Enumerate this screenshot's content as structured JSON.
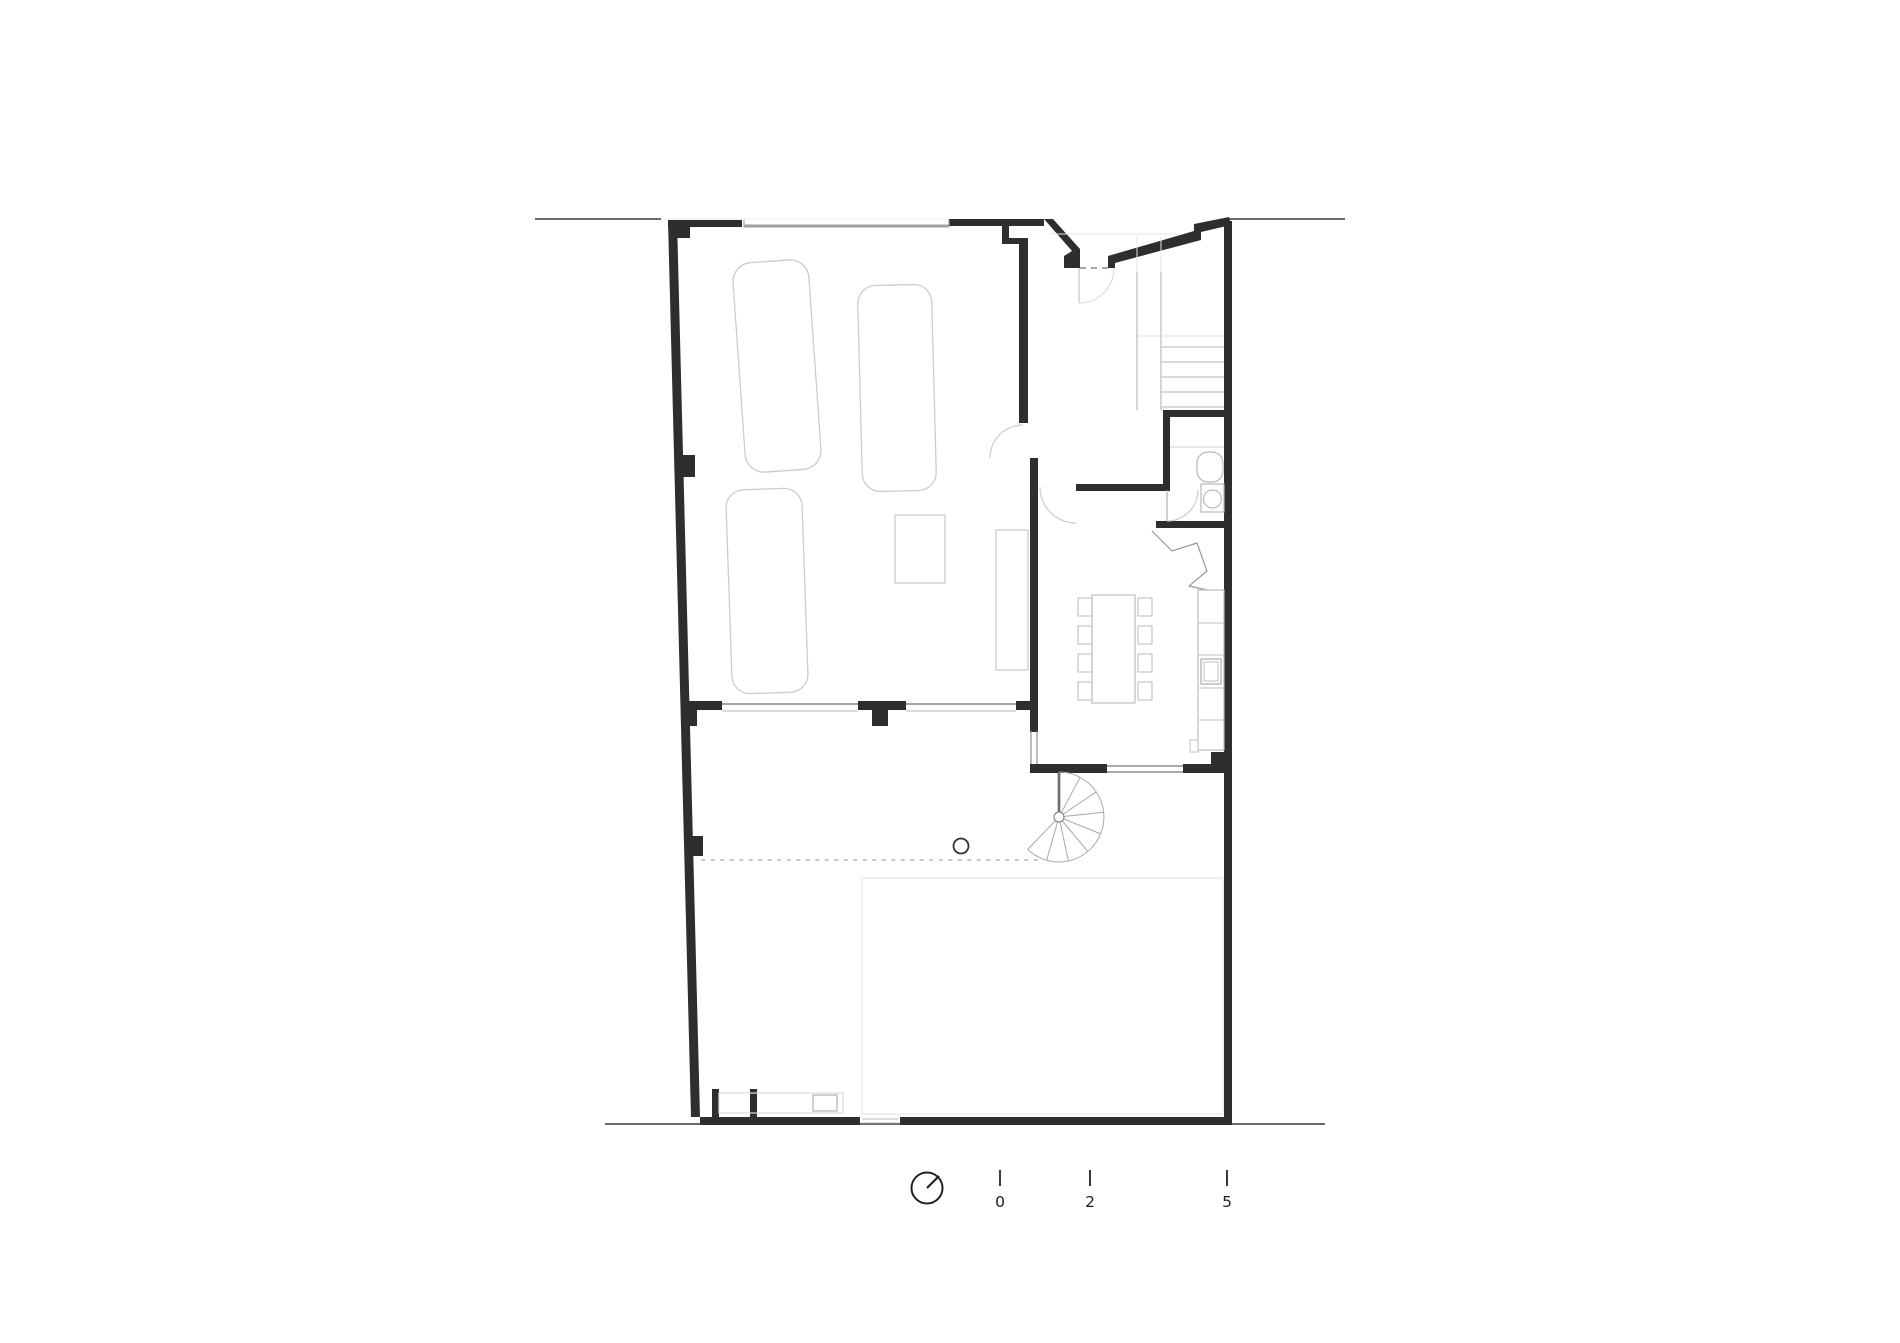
{
  "drawing": {
    "kind": "architectural ground floor plan",
    "colors": {
      "background": "#ffffff",
      "walls": "#2e2e2e",
      "site_lines": "#3a3a3a",
      "furniture_light": "#c9c9c9",
      "stair_gray": "#aaaaaa",
      "paving": "#e4e4e4",
      "garage_door": "#a0a0a0"
    },
    "symbols": [
      "car-outline",
      "car-outline",
      "car-outline",
      "straight-stair",
      "spiral-stair",
      "entry-door-arc",
      "interior-door-arc",
      "washbasin",
      "washing-machine",
      "dining-table",
      "chair",
      "kitchen-counter",
      "kitchen-sink",
      "tree",
      "canopy-dashed-line",
      "courtyard-paving",
      "gate-opening"
    ]
  },
  "north_arrow": {
    "icon": "north-arrow-icon",
    "needle_direction": "north-east"
  },
  "scale_bar": {
    "ticks": [
      {
        "label": "0"
      },
      {
        "label": "2"
      },
      {
        "label": "5"
      }
    ]
  }
}
